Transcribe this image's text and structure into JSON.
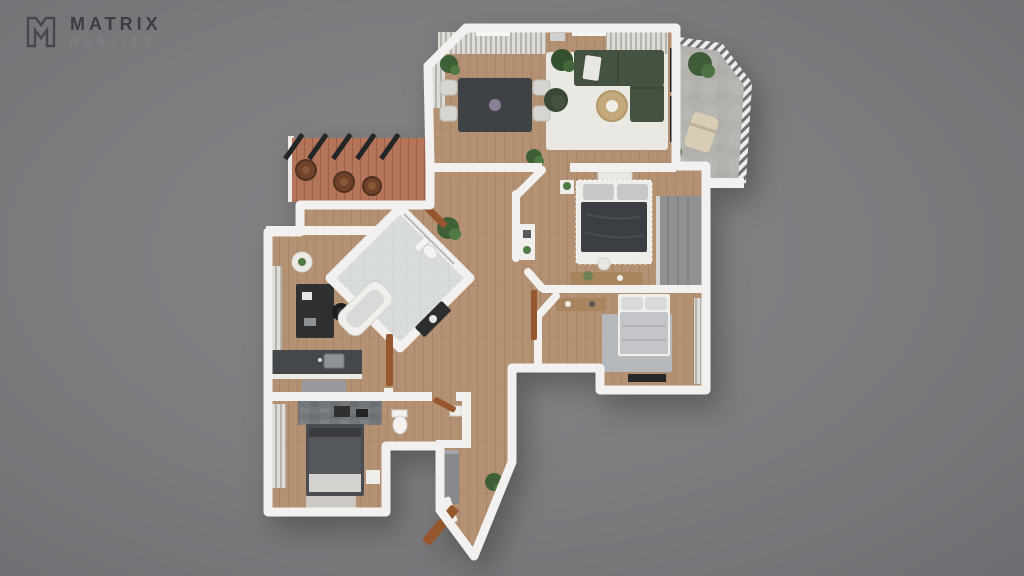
{
  "brand": {
    "name": "MATRIX",
    "tagline": "REALITY"
  },
  "scene": {
    "type": "3d-floor-plan-top-view",
    "rooms": [
      "living-dining-room",
      "balcony",
      "pergola-terrace",
      "kitchen-study",
      "bathroom",
      "master-bedroom",
      "bedroom-2",
      "bedroom-3",
      "wc",
      "entry-hall",
      "hallway"
    ]
  },
  "palette": {
    "background": "#7d7d80",
    "walls": "#f2f1ef",
    "wood_floor": "#b49173",
    "tile_floor": "#d9dcdd",
    "concrete_floor": "#b2b1ae",
    "terracotta_floor": "#b5755a",
    "sofa_green": "#465241",
    "door_wood": "#96572f",
    "logo_dark": "#3b3e45",
    "logo_light": "#84868b"
  }
}
